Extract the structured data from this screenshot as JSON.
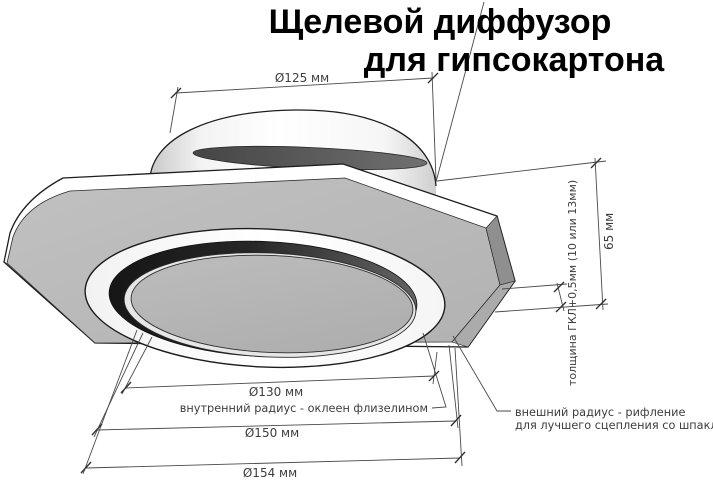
{
  "title": {
    "line1": "Щелевой диффузор",
    "line2": "для гипсокартона"
  },
  "dimensions": {
    "duct_diameter": "Ø125 мм",
    "inner_diameter": "Ø130 мм",
    "middle_diameter": "Ø150 мм",
    "outer_diameter": "Ø154 мм",
    "height": "65 мм",
    "panel_thickness": "толщина ГКЛ+0,5мм (10 или 13мм)"
  },
  "annotations": {
    "inner_radius": "внутренний радиус - оклеен флизелином",
    "outer_radius_line1": "внешний радиус - рифление",
    "outer_radius_line2": "для лучшего сцепления со шпаклёвкой"
  },
  "colors": {
    "background": "#ffffff",
    "panel_gray": "#b9b9b9",
    "slot_dark": "#2b2b2b",
    "outline": "#1d1d1d",
    "dimension_line": "#4a4a4a",
    "dimension_text": "#3d3d3d"
  }
}
